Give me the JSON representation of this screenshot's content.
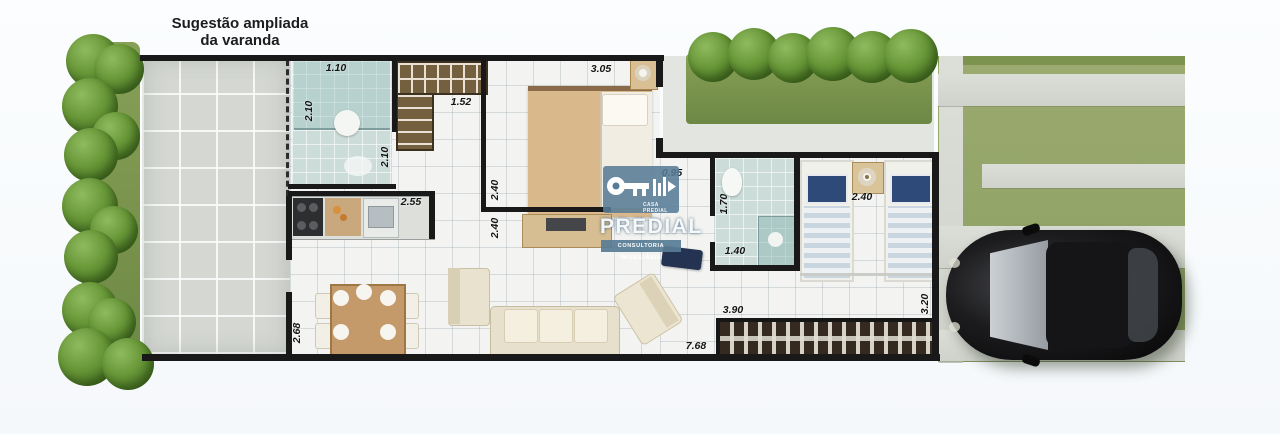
{
  "plan": {
    "title_line1": "Sugestão ampliada",
    "title_line2": "da varanda"
  },
  "watermark": {
    "brand": "PREDIAL",
    "tagline": "CONSULTORIA IMOBILIÁRIA",
    "logo_text": "CASA PREDIAL",
    "icon": "key-house-icon",
    "color": "#587c96"
  },
  "dims": {
    "bath1_width": "1.10",
    "bath1_depth": "2.10",
    "hall_depth": "2.10",
    "closet_width": "1.52",
    "bedroom1_width": "3.05",
    "kitchen_width": "2.55",
    "bedroom1_depth": "2.40",
    "living_width": "2.40",
    "hall_width": "0.95",
    "bath2_depth": "1.70",
    "bath2_width": "1.40",
    "bedroom2_width": "2.40",
    "varanda_depth": "2.68",
    "pergola_width": "3.90",
    "pergola_depth": "3.20",
    "total_width": "7.68"
  },
  "colors": {
    "wall": "#191919",
    "hedge_green": "#679637",
    "lawn_green": "#92a468",
    "bath_tile": "#cbdcd9",
    "wood_tan": "#cfa26e"
  }
}
